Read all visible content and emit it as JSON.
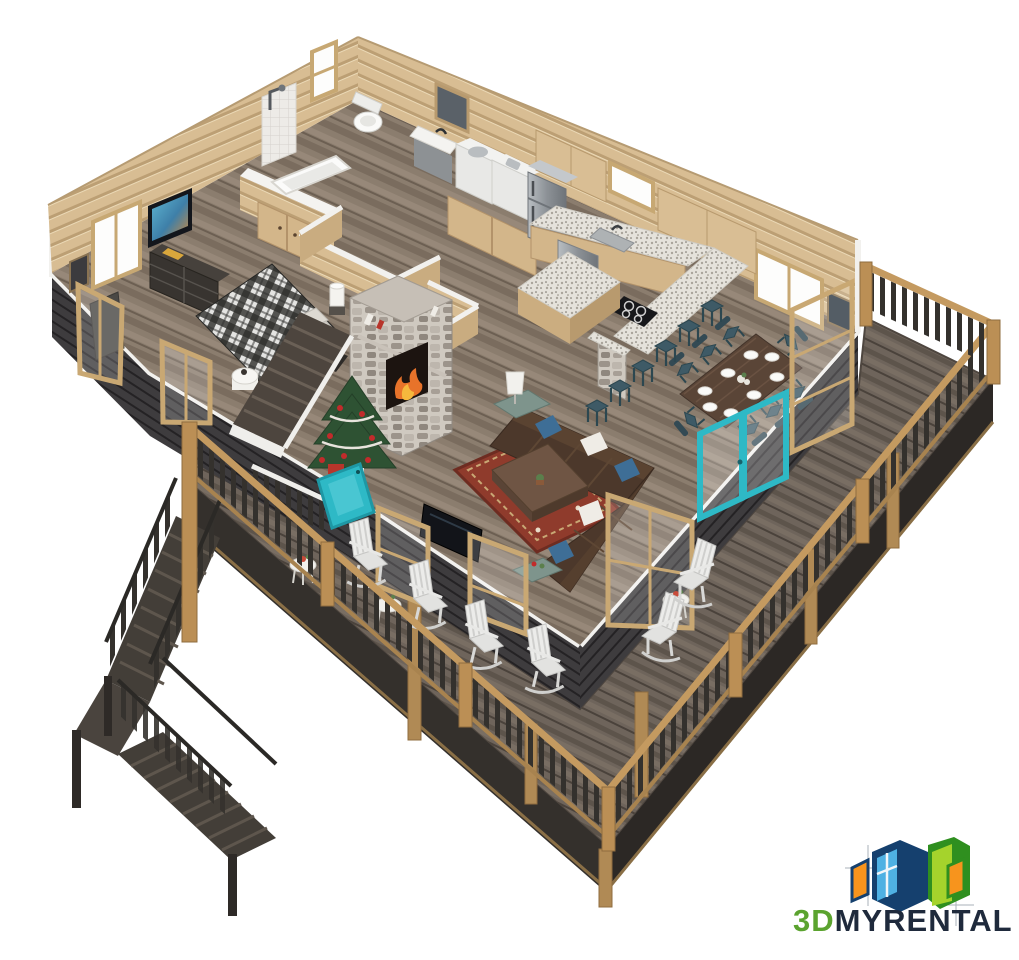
{
  "logo": {
    "text_green": "3D",
    "text_dark": "MYRENTAL",
    "color_green": "#5BA32F",
    "color_dark": "#1F2A3C",
    "icon_colors": {
      "navy": "#15406E",
      "blue": "#4FB1E3",
      "green": "#2F8F1F",
      "lime": "#A5D32C",
      "orange": "#F7941D"
    }
  },
  "scene": {
    "type": "isometric-3d-cutaway-floor-plan-render",
    "accent_teal": "#2EB9C6",
    "palette": {
      "log_wall": "#D8BD93",
      "interior_floor": "#8B7D6E",
      "deck_wood": "#6E645B",
      "dark_siding": "#3E3C3E",
      "railing_wood": "#C49A60",
      "granite": "#E5E2DB",
      "sofa_brown": "#4C382B",
      "rug_red": "#8F3B2C",
      "stone_grey": "#B3ACA3"
    },
    "rooms": [
      "wrap-around-deck",
      "living-room",
      "kitchen",
      "dining-area",
      "bedroom",
      "bathroom",
      "laundry",
      "hall-closet",
      "interior-stairs",
      "exterior-stairs"
    ],
    "furniture": [
      "sectional-sofa",
      "coffee-table",
      "area-rug",
      "tv",
      "stone-fireplace",
      "christmas-tree",
      "plaid-bed",
      "dresser",
      "bathtub",
      "shower",
      "toilet",
      "vanity-sink",
      "washer",
      "dryer",
      "refrigerator",
      "kitchen-island",
      "bar-counter",
      "bar-stools",
      "dining-table",
      "dining-chairs",
      "rocking-chairs",
      "side-tables",
      "teal-french-doors"
    ]
  }
}
